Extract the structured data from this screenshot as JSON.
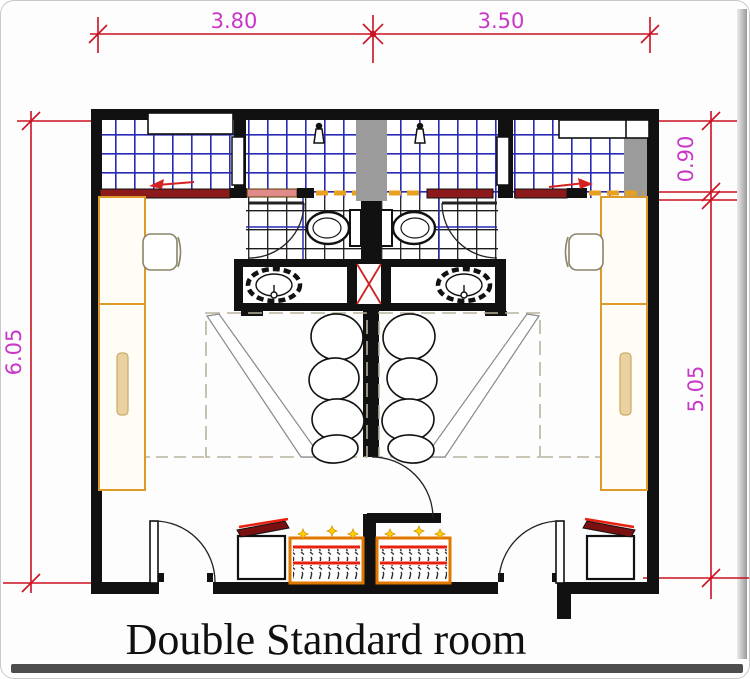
{
  "title": "Double Standard room",
  "dims": {
    "top_left": "3.80",
    "top_right": "3.50",
    "left": "6.05",
    "right_top": "0.90",
    "right_main": "5.05"
  },
  "plan": {
    "room_count": 2,
    "rooms": [
      "left standard room",
      "right standard room"
    ],
    "fixtures": [
      "shower-head",
      "toilet",
      "wash-basin",
      "vanity",
      "double-bed",
      "pillows",
      "desk",
      "chair",
      "wardrobe-sliding-door",
      "tv-stand",
      "minibar-cabinet",
      "entry-door",
      "bathroom-door",
      "connecting-door",
      "service-shaft"
    ]
  },
  "colors": {
    "dimension_line": "#cc1122",
    "dimension_text": "#c837c8",
    "wall": "#111111",
    "tile_grid_blue": "#2a2ab4",
    "tile_grid_dark": "#1a1a1a",
    "shaft_gray": "#9b9b9b",
    "desk_orange": "#dc9a28",
    "cabinet_orange": "#e07800",
    "accent_red": "#e82010",
    "tv_dark_red": "#7a1010",
    "sparkle_yellow": "#ffd400"
  }
}
